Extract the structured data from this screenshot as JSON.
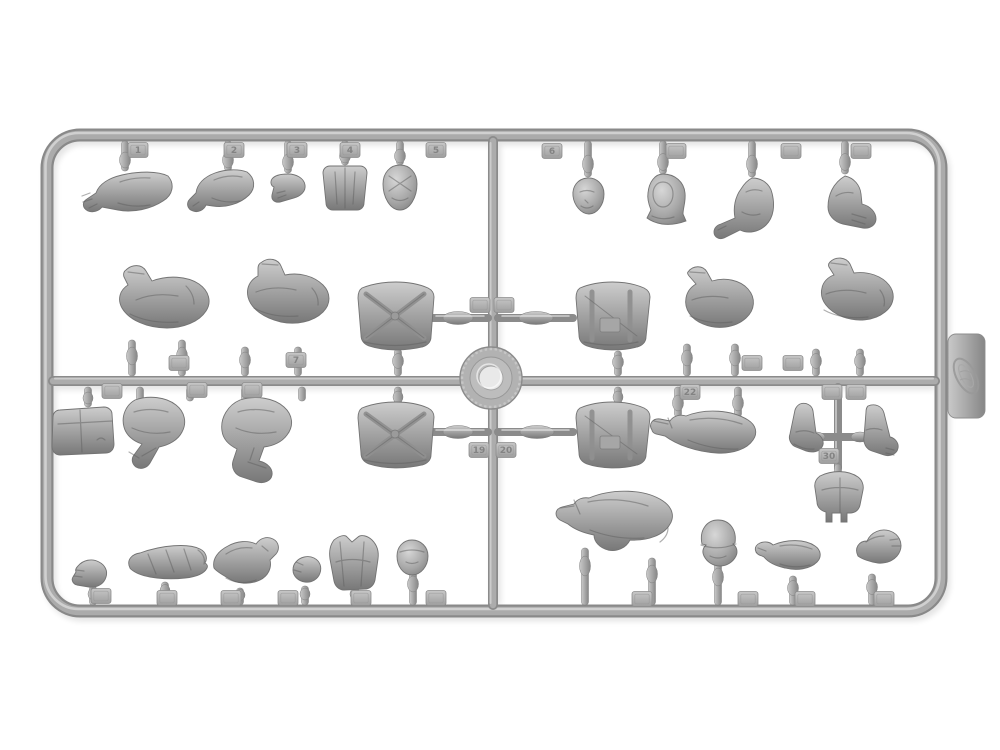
{
  "colors": {
    "background": "#ffffff",
    "plastic_mid": "#a7a7a7",
    "plastic_light": "#d6d6d6",
    "plastic_dark": "#7b7b7b",
    "plastic_shadow": "#5e5e5e",
    "tag_number": "#838383",
    "hub_hole": "#e9e9e9"
  },
  "tags": {
    "top_row": [
      "1",
      "2",
      "3",
      "4",
      "5",
      "6",
      "",
      "",
      ""
    ],
    "hub": [
      "",
      "",
      "19",
      "20"
    ],
    "mid_above": [
      "",
      "7",
      "",
      ""
    ],
    "mid_below": [
      "",
      "",
      "",
      "22",
      "",
      "",
      "30"
    ],
    "bottom_row": [
      "",
      "",
      "",
      "",
      "",
      "",
      "",
      "",
      "",
      ""
    ]
  },
  "parts": {
    "top_row": [
      "gloved-arm",
      "gloved-arm",
      "hand",
      "equipment-pouch",
      "helmeted-head",
      "bare-head",
      "hooded-head",
      "bent-arm",
      "bent-arm"
    ],
    "middle_above_rail": [
      "folded-legs",
      "folded-legs",
      "torso-back",
      "torso-front",
      "bent-leg",
      "folded-legs"
    ],
    "middle_below_rail": [
      "pouch",
      "folded-legs",
      "folded-legs",
      "torso-back",
      "torso-front",
      "extended-legs",
      "boot",
      "forearm",
      "hips"
    ],
    "bottom_row": [
      "hand",
      "bed-roll",
      "bent-arm",
      "hand",
      "vest",
      "head",
      "kneeling-legs",
      "capped-head",
      "forearm",
      "forearm-hand"
    ]
  }
}
